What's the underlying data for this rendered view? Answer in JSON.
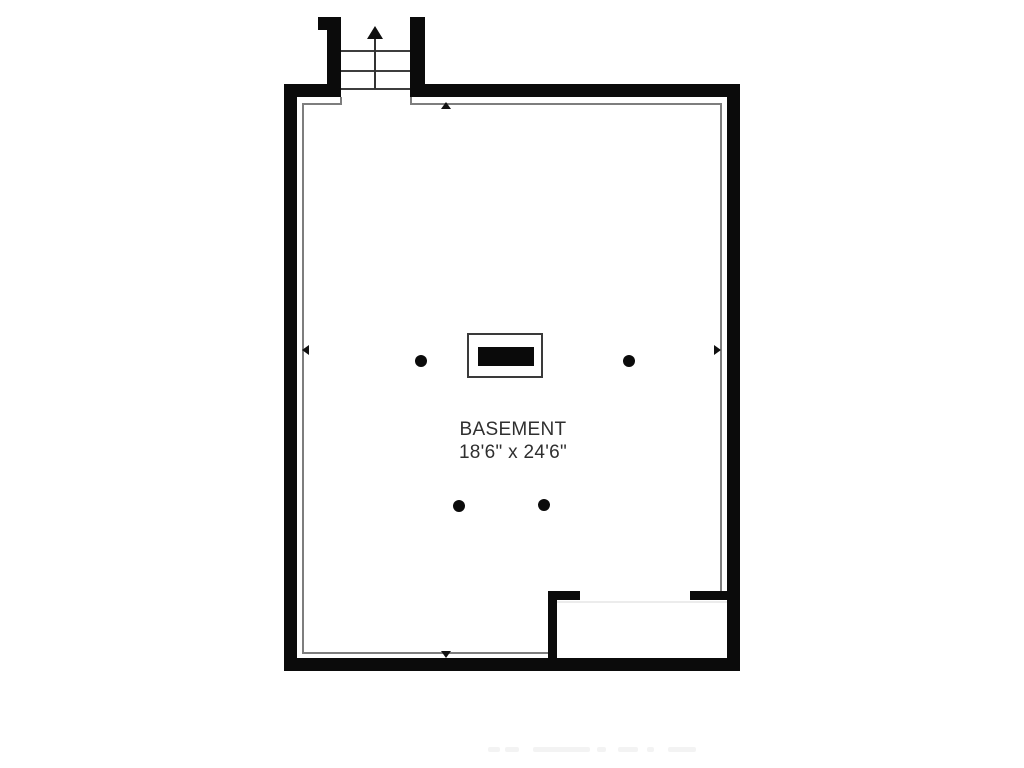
{
  "room": {
    "label": "BASEMENT",
    "dimensions": "18'6\" x 24'6\""
  },
  "colors": {
    "wall": "#0b0b0b",
    "inner_outline": "#7e7e7e",
    "background": "#ffffff",
    "text": "#2f2f2f"
  },
  "icons": {
    "stair_direction": "up-arrow",
    "dimension_markers": [
      "up-arrow",
      "down-arrow",
      "left-arrow",
      "right-arrow"
    ]
  },
  "features": {
    "staircase": "3 treads, leads up, top center-left",
    "fireplace_footprint": "outlined rectangle with solid black insert, room center",
    "support_posts": 4,
    "alcove": "bottom-right enclosed area with door opening"
  }
}
